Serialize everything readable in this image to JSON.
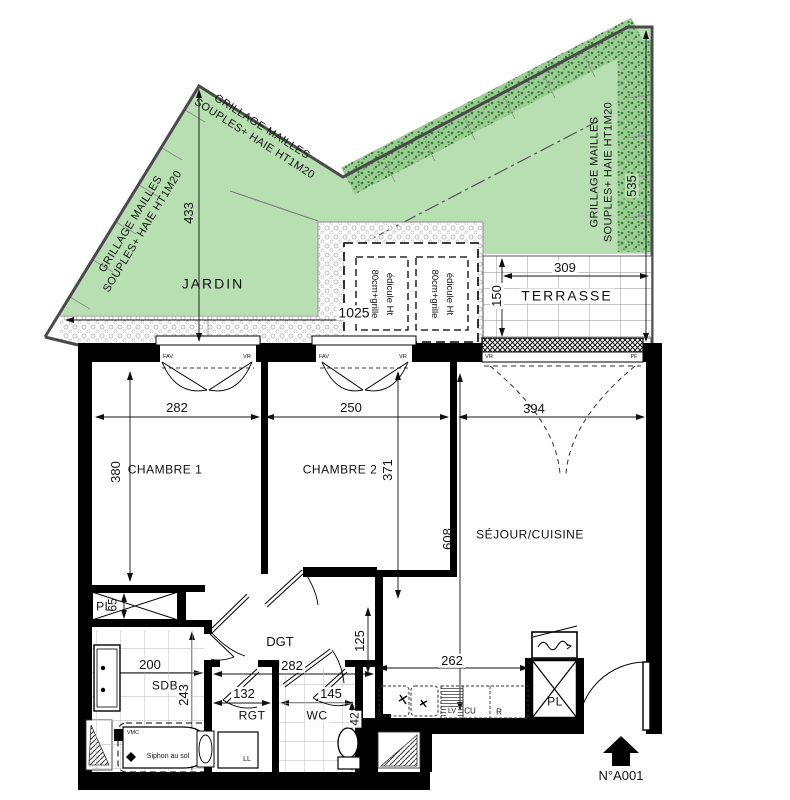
{
  "garden": {
    "label": "JARDIN",
    "fence_note_line1": "GRILLAGE MAILLES",
    "fence_note_line2": "SOUPLES+ HAIE HT1M20",
    "dim_depth_left": "433",
    "dim_depth_right": "535",
    "dim_width": "1025"
  },
  "terrace": {
    "label": "TERRASSE",
    "dim_width": "309",
    "dim_depth": "150",
    "shutter_label": "VR",
    "door_label": "PF"
  },
  "edicule": {
    "line1": "édicule Ht",
    "line2": "80cm+grille"
  },
  "rooms": {
    "chambre1": {
      "label": "CHAMBRE 1",
      "dim_width": "282",
      "dim_depth": "380"
    },
    "chambre2": {
      "label": "CHAMBRE 2",
      "dim_width": "250",
      "dim_depth": "371"
    },
    "sejour": {
      "label": "SÉJOUR/CUISINE",
      "dim_width": "394",
      "dim_depth": "608"
    },
    "dgt": {
      "label": "DGT",
      "dim_width": "282",
      "dim_depth": "125"
    },
    "sdb": {
      "label": "SDB",
      "dim_width": "200",
      "dim_depth": "243"
    },
    "rgt": {
      "label": "RGT",
      "dim_width": "132"
    },
    "wc": {
      "label": "WC",
      "dim_width": "145",
      "dim_clear": "42"
    },
    "kitchen": {
      "dim_width": "262",
      "hob_label": "CU",
      "fridge_label": "R",
      "dishwasher_label": "LV"
    },
    "closet1": {
      "label": "PL",
      "dim_depth": "65"
    },
    "closet2": {
      "label": "PL"
    }
  },
  "fixtures": {
    "washing_machine": "LL",
    "floor_drain": "Siphon au sol",
    "vent": "VMC"
  },
  "windows": {
    "casement_label": "FAV",
    "shutter_label": "VR"
  },
  "entrance": {
    "unit_number": "N°A001"
  },
  "colors": {
    "garden_green": "#b7dfb1",
    "hedge_green": "#2f7d2f",
    "wall": "#000000"
  }
}
